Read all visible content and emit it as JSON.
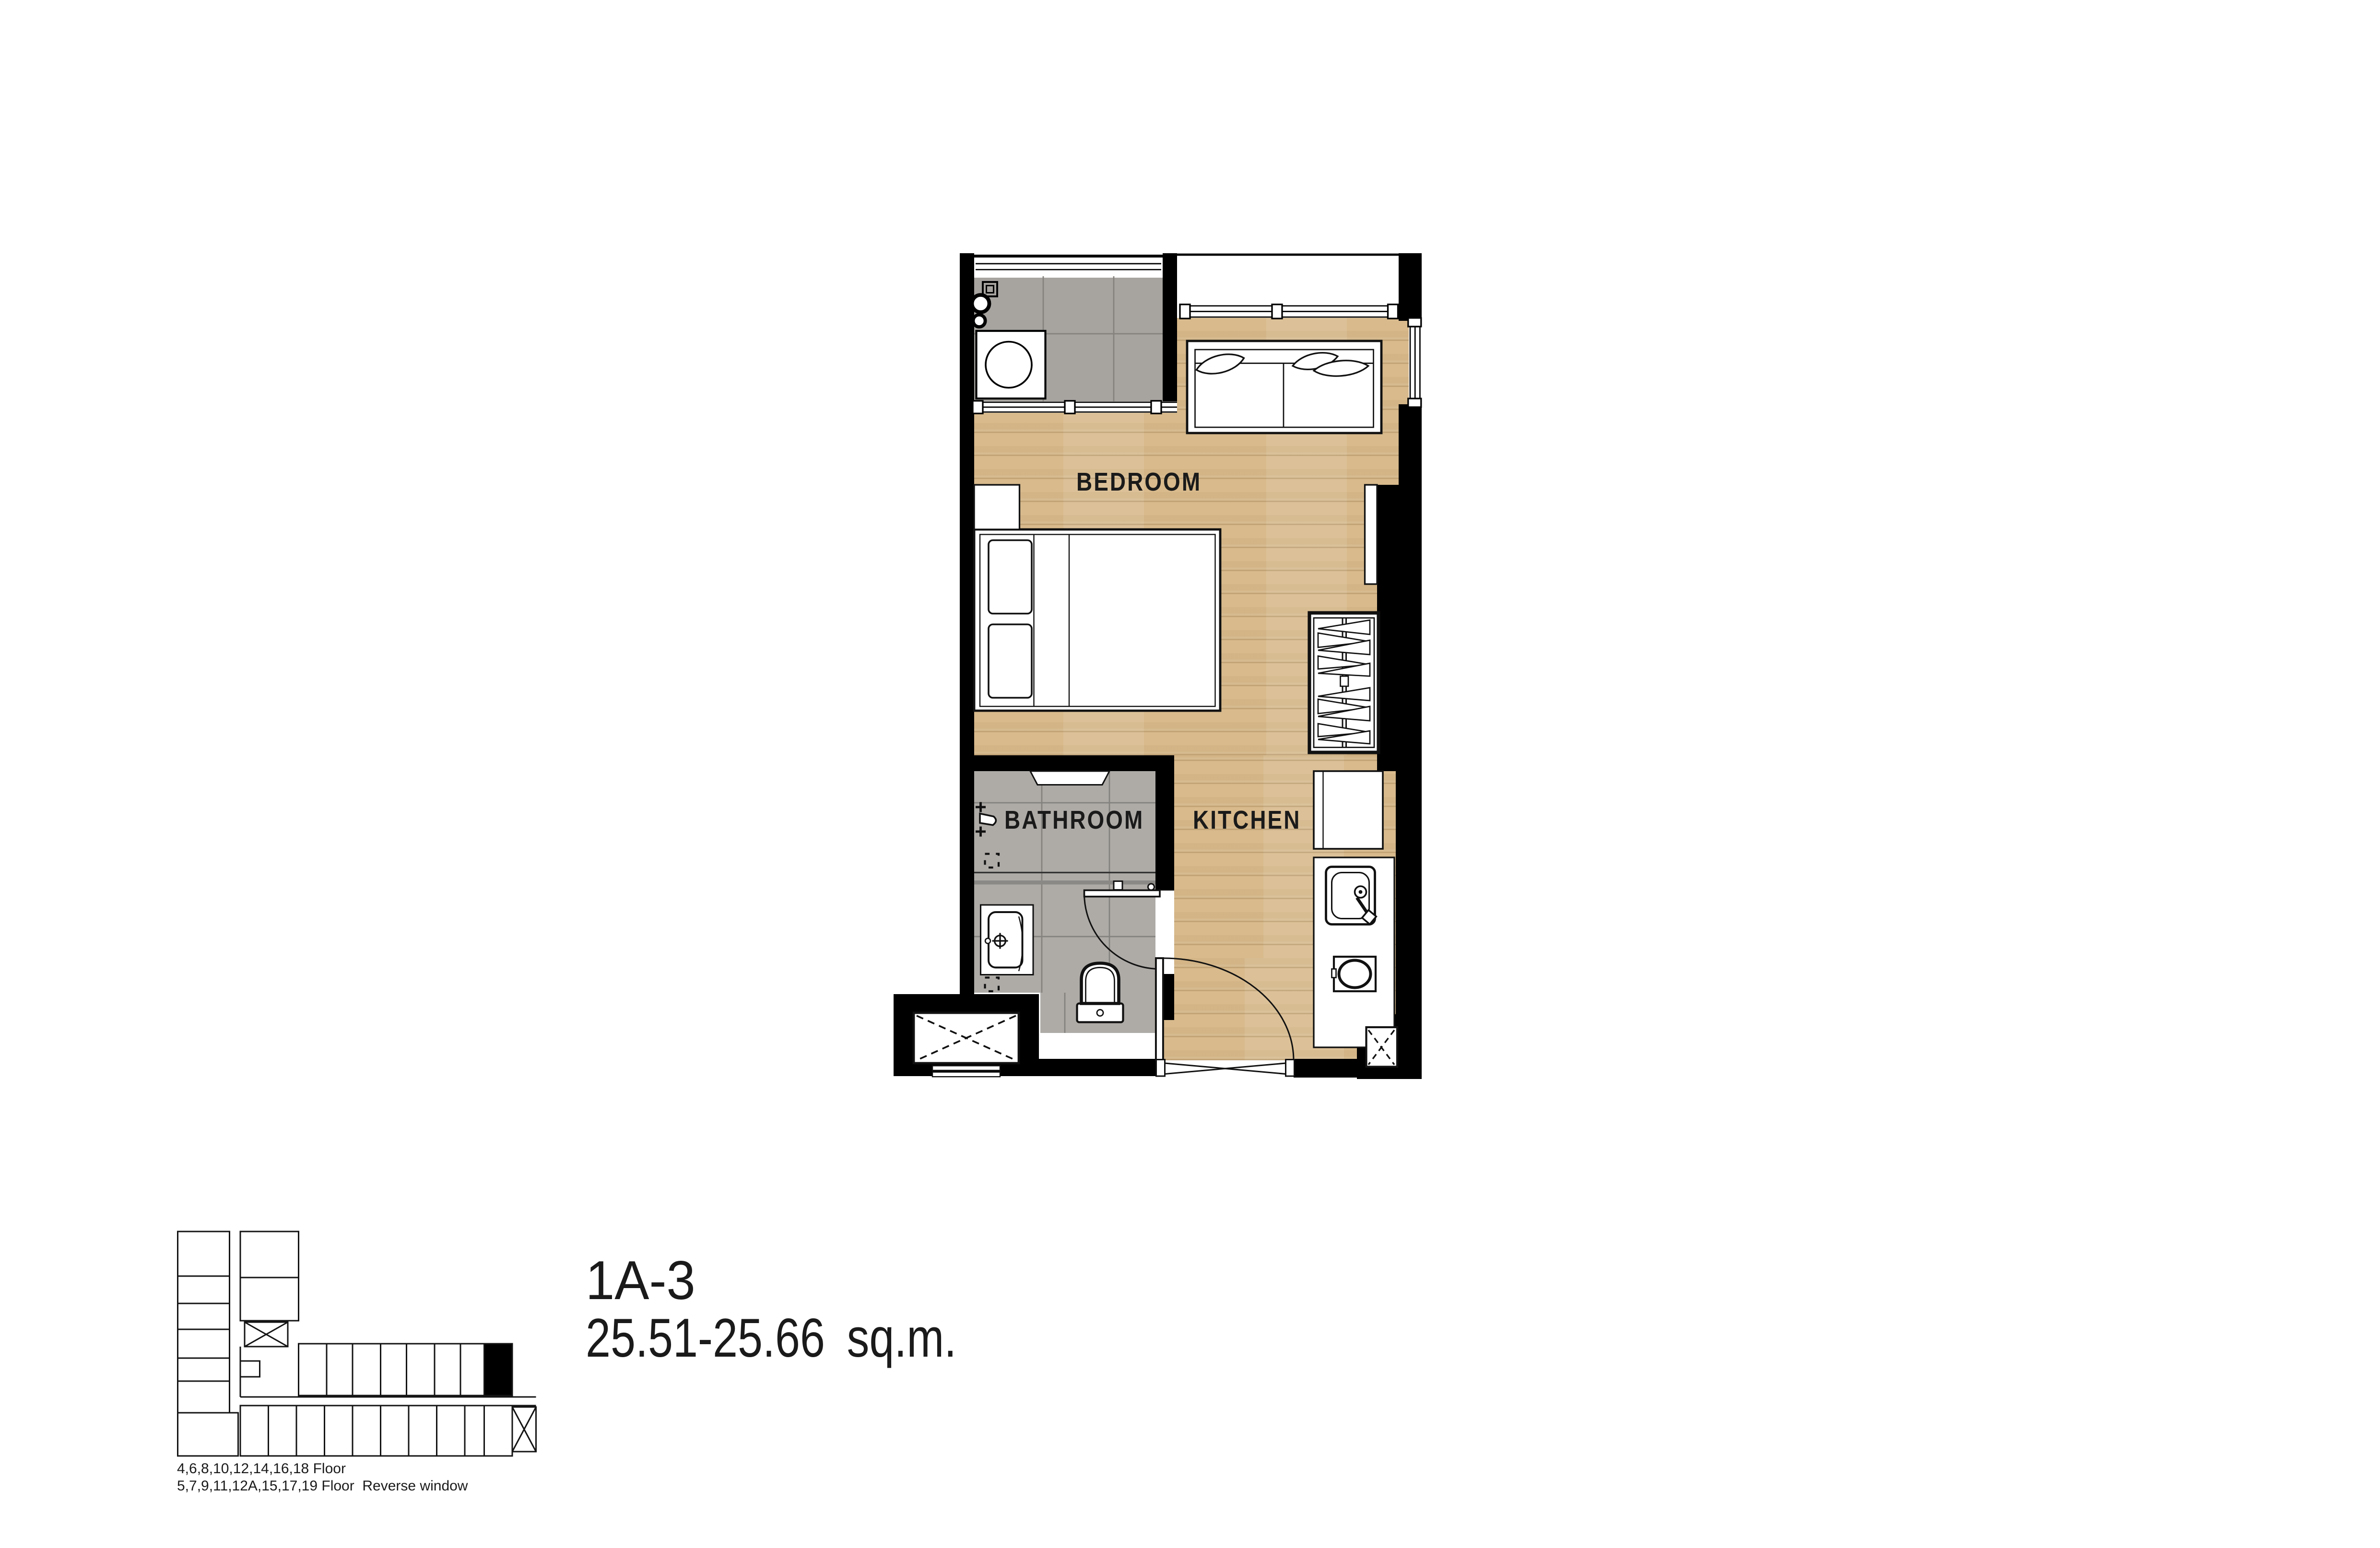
{
  "title": {
    "unit": "1A-3",
    "area": "25.51-25.66 sq.m."
  },
  "plan": {
    "rooms": {
      "bedroom": "BEDROOM",
      "bathroom": "BATHROOM",
      "kitchen": "KITCHEN"
    },
    "fixture_symbols": [
      "balcony-washing-machine",
      "laundry-faucet",
      "floor-drain",
      "sofa",
      "double-bed",
      "nightstand",
      "wardrobe-with-hangers",
      "mirror-panel",
      "refrigerator",
      "kitchen-counter",
      "kitchen-sink",
      "cooktop",
      "bathroom-vanity",
      "toilet",
      "shower-set",
      "bathroom-door",
      "entrance-door",
      "elevator-shaft",
      "service-shaft",
      "sliding-window"
    ]
  },
  "key_plan": {
    "floor_notes": [
      "4,6,8,10,12,14,16,18 Floor",
      "5,7,9,11,12A,15,17,19 Floor  Reverse window"
    ]
  },
  "colors": {
    "wall": "#000000",
    "wood_floor": "#d8ba8c",
    "tile_balcony": "#a7a4a0",
    "tile_bathroom": "#aeaba7",
    "ink": "#1a1a1a",
    "background": "#ffffff",
    "highlight_unit": "#000000"
  }
}
